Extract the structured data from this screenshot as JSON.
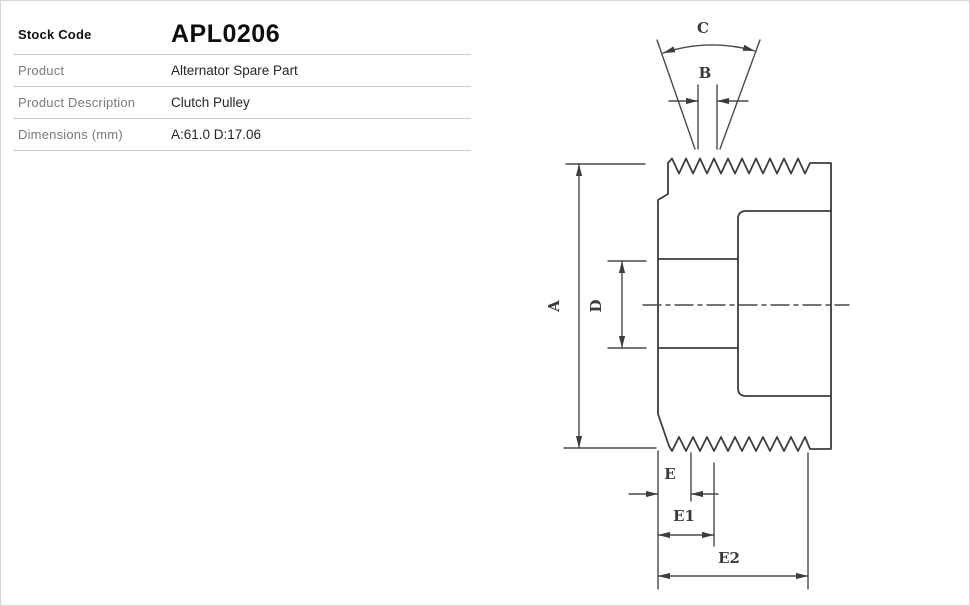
{
  "table": {
    "rows": [
      {
        "label": "Stock Code",
        "value": "APL0206"
      },
      {
        "label": "Product",
        "value": "Alternator Spare Part"
      },
      {
        "label": "Product Description",
        "value": "Clutch Pulley"
      },
      {
        "label": "Dimensions (mm)",
        "value": "A:61.0 D:17.06"
      }
    ]
  },
  "diagram": {
    "labels": {
      "a": "A",
      "b": "B",
      "c": "C",
      "d": "D",
      "e": "E",
      "e1": "E1",
      "e2": "E2"
    },
    "dimensions_mm": {
      "A": "61.0",
      "D": "17.06"
    }
  }
}
